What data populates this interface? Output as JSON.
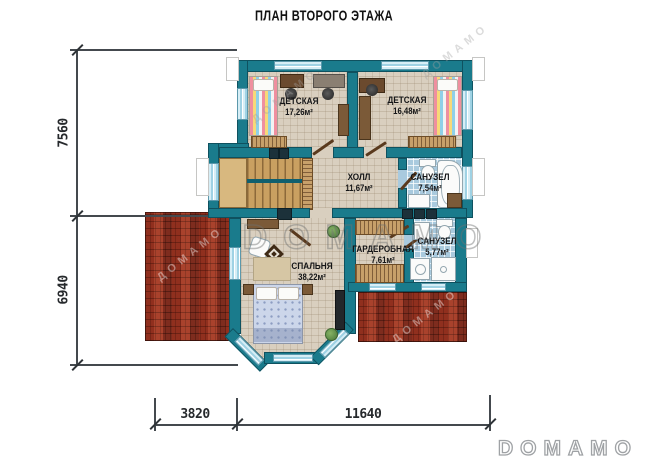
{
  "title": "ПЛАН ВТОРОГО ЭТАЖА",
  "rooms": [
    {
      "id": "kids1",
      "name": "ДЕТСКАЯ",
      "area": "17,26м²"
    },
    {
      "id": "kids2",
      "name": "ДЕТСКАЯ",
      "area": "16,48м²"
    },
    {
      "id": "hall",
      "name": "ХОЛЛ",
      "area": "11,67м²"
    },
    {
      "id": "bath1",
      "name": "САНУЗЕЛ",
      "area": "7,54м²"
    },
    {
      "id": "bedroom",
      "name": "СПАЛЬНЯ",
      "area": "38,22м²"
    },
    {
      "id": "wardrobe",
      "name": "ГАРДЕРОБНАЯ",
      "area": "7,61м²"
    },
    {
      "id": "bath2",
      "name": "САНУЗЕЛ",
      "area": "5,77м²"
    }
  ],
  "dimensions": {
    "left": [
      "7560",
      "6940"
    ],
    "bottom": [
      "3820",
      "11640"
    ]
  },
  "watermarks": {
    "center": "DOMAMO",
    "logo": "DOMAMO",
    "diagonal": "ДОМАМО"
  },
  "colors": {
    "wall": "#1a7b8c",
    "floor": "#d9cfbf",
    "bathroom_tile": "#a9cade",
    "wood": "#c9a061",
    "roof_brick": "#9e3a28",
    "window_glass": "#9fd2e4",
    "dimension_line": "#44494e"
  }
}
